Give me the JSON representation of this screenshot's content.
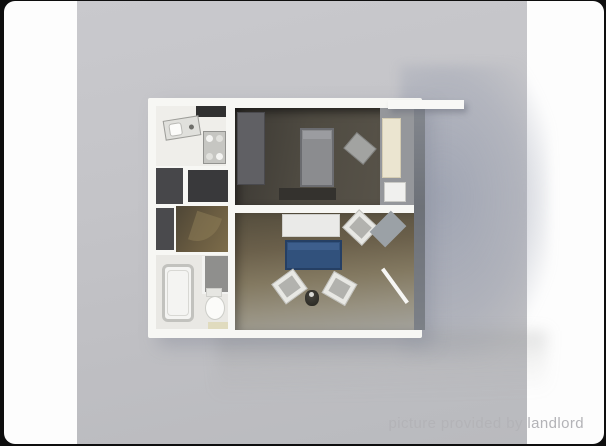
{
  "photo_viewer": {
    "watermark_text": "picture provided by landlord"
  },
  "colors": {
    "page_bg": "#0e0e0e",
    "card_bg": "#fdfdfd",
    "photo_bg": "#c4c4c8",
    "photo_bg_bottom": "#b9babe",
    "wall": "#f7f7f4",
    "bedroom_floor": "#4e4a41",
    "living_floor_mid": "#837961",
    "hall_floor": "#6a5c41",
    "bathroom_floor": "#e9e8e4",
    "corridor_floor": "#95979b",
    "bed_gray": "#8b8c8f",
    "sofa_blue": "#31517c",
    "wardrobe_cream": "#ebe5d0",
    "watermark": "#b3b3b7"
  },
  "floorplan": {
    "type": "3d-apartment-floorplan-render",
    "rooms": [
      "kitchen",
      "hallway",
      "bathroom",
      "bedroom",
      "living-room",
      "entry-corridor"
    ],
    "furniture": [
      "kitchen-sink",
      "stove",
      "kitchen-cabinet",
      "storage-closets",
      "bathtub",
      "toilet",
      "shower",
      "bath-mat",
      "bedroom-closet",
      "bed",
      "bedroom-chair",
      "dresser",
      "wardrobe",
      "table",
      "sofa",
      "armchairs",
      "stool",
      "doors"
    ]
  }
}
